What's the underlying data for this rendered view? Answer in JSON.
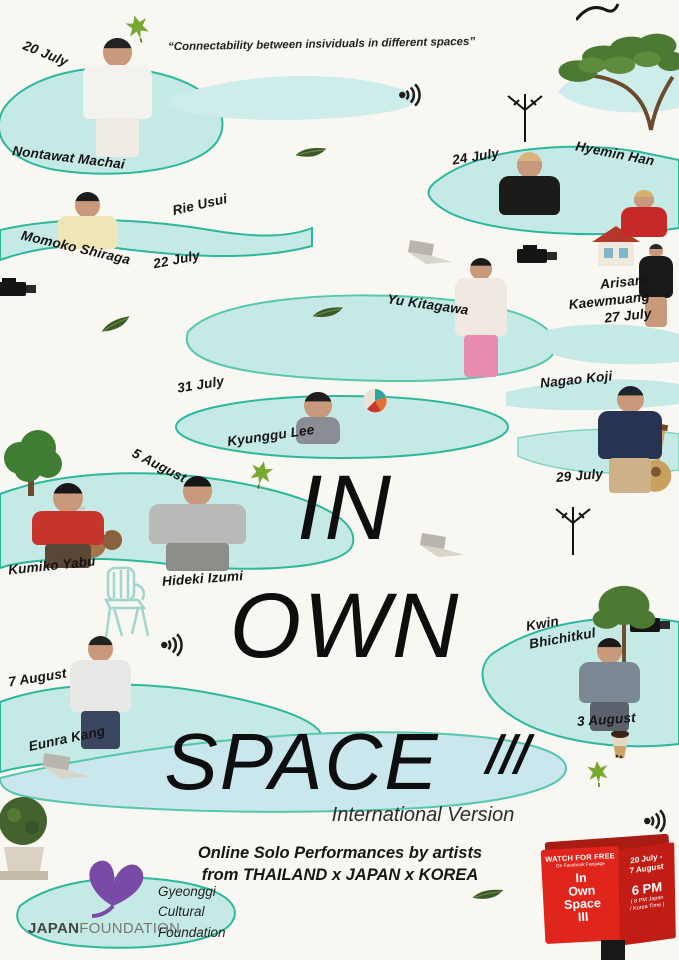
{
  "poster": {
    "quote": "“Connectability between insividuals in different spaces”",
    "title": {
      "word1": "IN",
      "word2": "OWN",
      "word3": "SPACE",
      "numeral": "III",
      "subtitle": "International Version"
    },
    "tagline": "Online Solo Performances by artists\nfrom THAILAND x JAPAN x KOREA"
  },
  "artists": [
    {
      "date": "20 July",
      "name": "Nontawat Machai"
    },
    {
      "date": "24 July",
      "name": "Hyemin Han"
    },
    {
      "date": "22 July",
      "name": "Rie Usui"
    },
    {
      "name": "Momoko Shiraga"
    },
    {
      "name": "Yu Kitagawa"
    },
    {
      "name": "Arisara Kaewmuang",
      "date": "27 July"
    },
    {
      "date": "31 July",
      "name": "Kyunggu Lee"
    },
    {
      "name": "Nagao Koji",
      "date": "29 July"
    },
    {
      "name": "Kumiko Yabu"
    },
    {
      "date": "5 August",
      "name": "Hideki Izumi"
    },
    {
      "name": "Kwin Bhichitkul",
      "date": "3 August"
    },
    {
      "date": "7 August",
      "name": "Eunra Kang"
    }
  ],
  "watch_box": {
    "heading": "WATCH FOR FREE",
    "subheading": "On Facebook Fanpage",
    "title": "In\nOwn\nSpace\nIII",
    "dates": "20 July -\n7 August",
    "time": "6 PM",
    "time_note": "( 8 PM Japan\n/ Korea Time )"
  },
  "logos": {
    "japan_foundation_bold": "JAPAN",
    "japan_foundation_light": "FOUNDATION",
    "gyeonggi": "Gyeonggi\nCultural\nFoundation"
  },
  "colors": {
    "blob_fill": "#c5eae6",
    "blob_fill_blue": "#c9e7ec",
    "blob_stroke": "#2db89b",
    "box_red": "#e0251c",
    "logo_purple": "#7a4ba6",
    "leaf_green": "#76a832"
  },
  "decorations": [
    "maple-leaf",
    "bay-leaf",
    "broadcast-signal",
    "laptop",
    "video-camera",
    "tv-antenna",
    "tree",
    "garden-chair",
    "beach-ball",
    "bubble-tea",
    "topiary",
    "house",
    "guitar",
    "drum-kit",
    "branch-squiggle"
  ]
}
